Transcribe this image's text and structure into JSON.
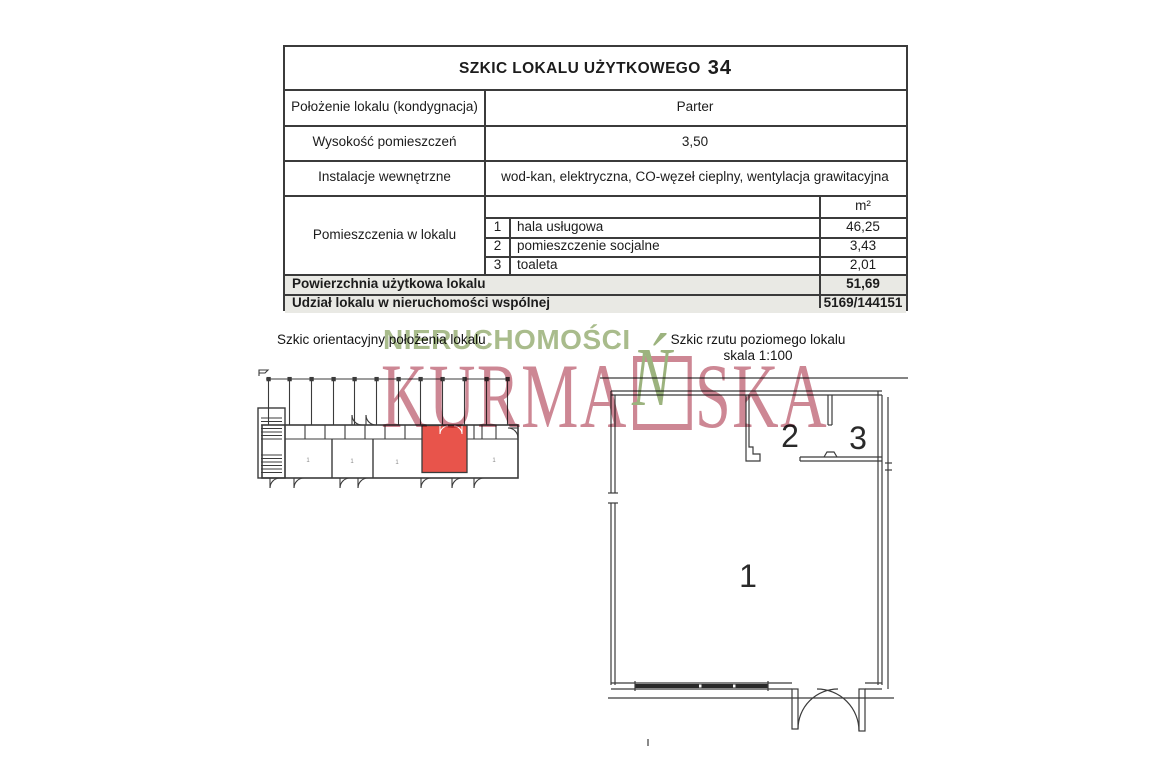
{
  "page": {
    "title": {
      "text": "SZKIC LOKALU UŻYTKOWEGO",
      "number": "34"
    },
    "table": {
      "rows": [
        {
          "label": "Położenie lokalu (kondygnacja)",
          "value": "Parter"
        },
        {
          "label": "Wysokość pomieszczeń",
          "value": "3,50"
        },
        {
          "label": "Instalacje wewnętrzne",
          "value": "wod-kan, elektryczna, CO-węzeł cieplny, wentylacja grawitacyjna"
        }
      ],
      "rooms": {
        "header_label": "Pomieszczenia w lokalu",
        "unit": "m²",
        "items": [
          {
            "no": "1",
            "name": "hala usługowa",
            "area": "46,25"
          },
          {
            "no": "2",
            "name": "pomieszczenie socjalne",
            "area": "3,43"
          },
          {
            "no": "3",
            "name": "toaleta",
            "area": "2,01"
          }
        ]
      },
      "summary": [
        {
          "label": "Powierzchnia użytkowa lokalu",
          "value": "51,69"
        },
        {
          "label": "Udział lokalu w nieruchomości wspólnej",
          "value": "5169/144151"
        }
      ]
    },
    "captions": {
      "orientation": "Szkic orientacyjny położenia lokalu",
      "floor_plan": "Szkic rzutu poziomego lokalu",
      "scale": "skala 1:100"
    },
    "watermark": {
      "word1": "NIERUCHOMOŚCI",
      "word2_prefix": "KURMA",
      "word2_accent_letter": "Ń",
      "word2_suffix": "SKA",
      "color_green": "#a9bc8c",
      "color_rose": "#cd8794"
    },
    "floor_plan": {
      "room_labels": [
        "1",
        "2",
        "3"
      ]
    },
    "orientation_plan": {
      "highlight_color": "#e8544b",
      "room_label": "1"
    }
  }
}
